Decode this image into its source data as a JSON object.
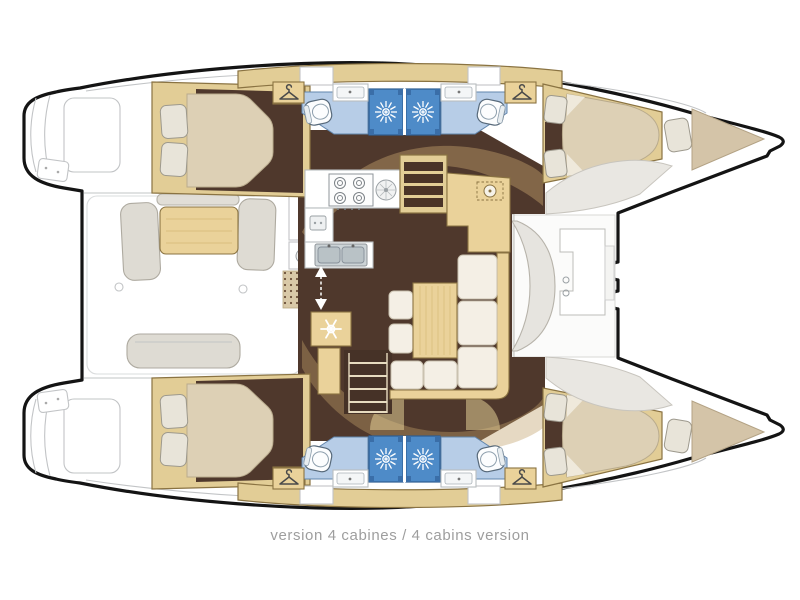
{
  "caption": {
    "text": "version 4 cabines / 4 cabins version"
  },
  "palette": {
    "outline": "#141414",
    "lineGray": "#c2c4c6",
    "floorBrown": "#4f382c",
    "floorBrownDark": "#463227",
    "wood": "#ead29a",
    "woodDark": "#e2cd96",
    "woodStroke": "#8a7342",
    "woodGrain": "#d9bd7e",
    "mattress": "#ddd0b5",
    "mattressStroke": "#b9ab8d",
    "pillow": "#e8e4d9",
    "pillowStroke": "#9d998d",
    "cushion": "#f4efe5",
    "cushionStroke": "#cac2b0",
    "bathFloor": "#b7cde7",
    "bathFloorStroke": "#6286ad",
    "shower": "#4e8bc8",
    "showerDark": "#3a6ea8",
    "showerStroke": "#2e5d91",
    "seatGray": "#dedbd3",
    "seatGrayStroke": "#aeaaa0",
    "deckShape": "#e9e7e2",
    "deckShapeStroke": "#c8c5be",
    "bowBerth": "#d4c4a8",
    "bowBerthStroke": "#b3a284",
    "matTan": "#d9c9a8",
    "matDot": "#6b4f38",
    "archTan": "#c1a06a",
    "counterStroke": "#b9bdbf",
    "applianceStroke": "#8f959a",
    "captionGray": "#9e9e9e"
  },
  "icons": {
    "shower_rose": "white starburst on blue stall",
    "wardrobe_hanger": "clothes hanger outline",
    "fridge_snowflake": "white snowflake on wood locker",
    "stove_burners": "four gas rings",
    "companionway_arrow": "white double-headed dashed arrow",
    "galley_sink": "double basin",
    "toilet": "bowl with cistern"
  }
}
